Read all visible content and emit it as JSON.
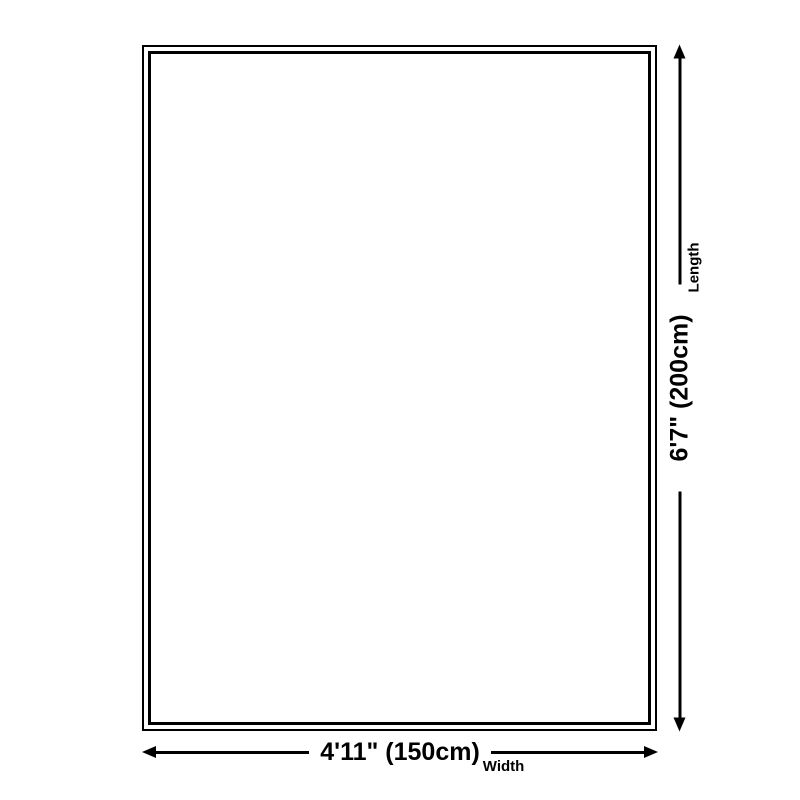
{
  "diagram": {
    "width_annotation": {
      "value": "4'11\" (150cm)",
      "label": "Width"
    },
    "length_annotation": {
      "value": "6'7\" (200cm)",
      "label": "Length"
    },
    "colors": {
      "line": "#000000",
      "background": "#ffffff"
    }
  }
}
